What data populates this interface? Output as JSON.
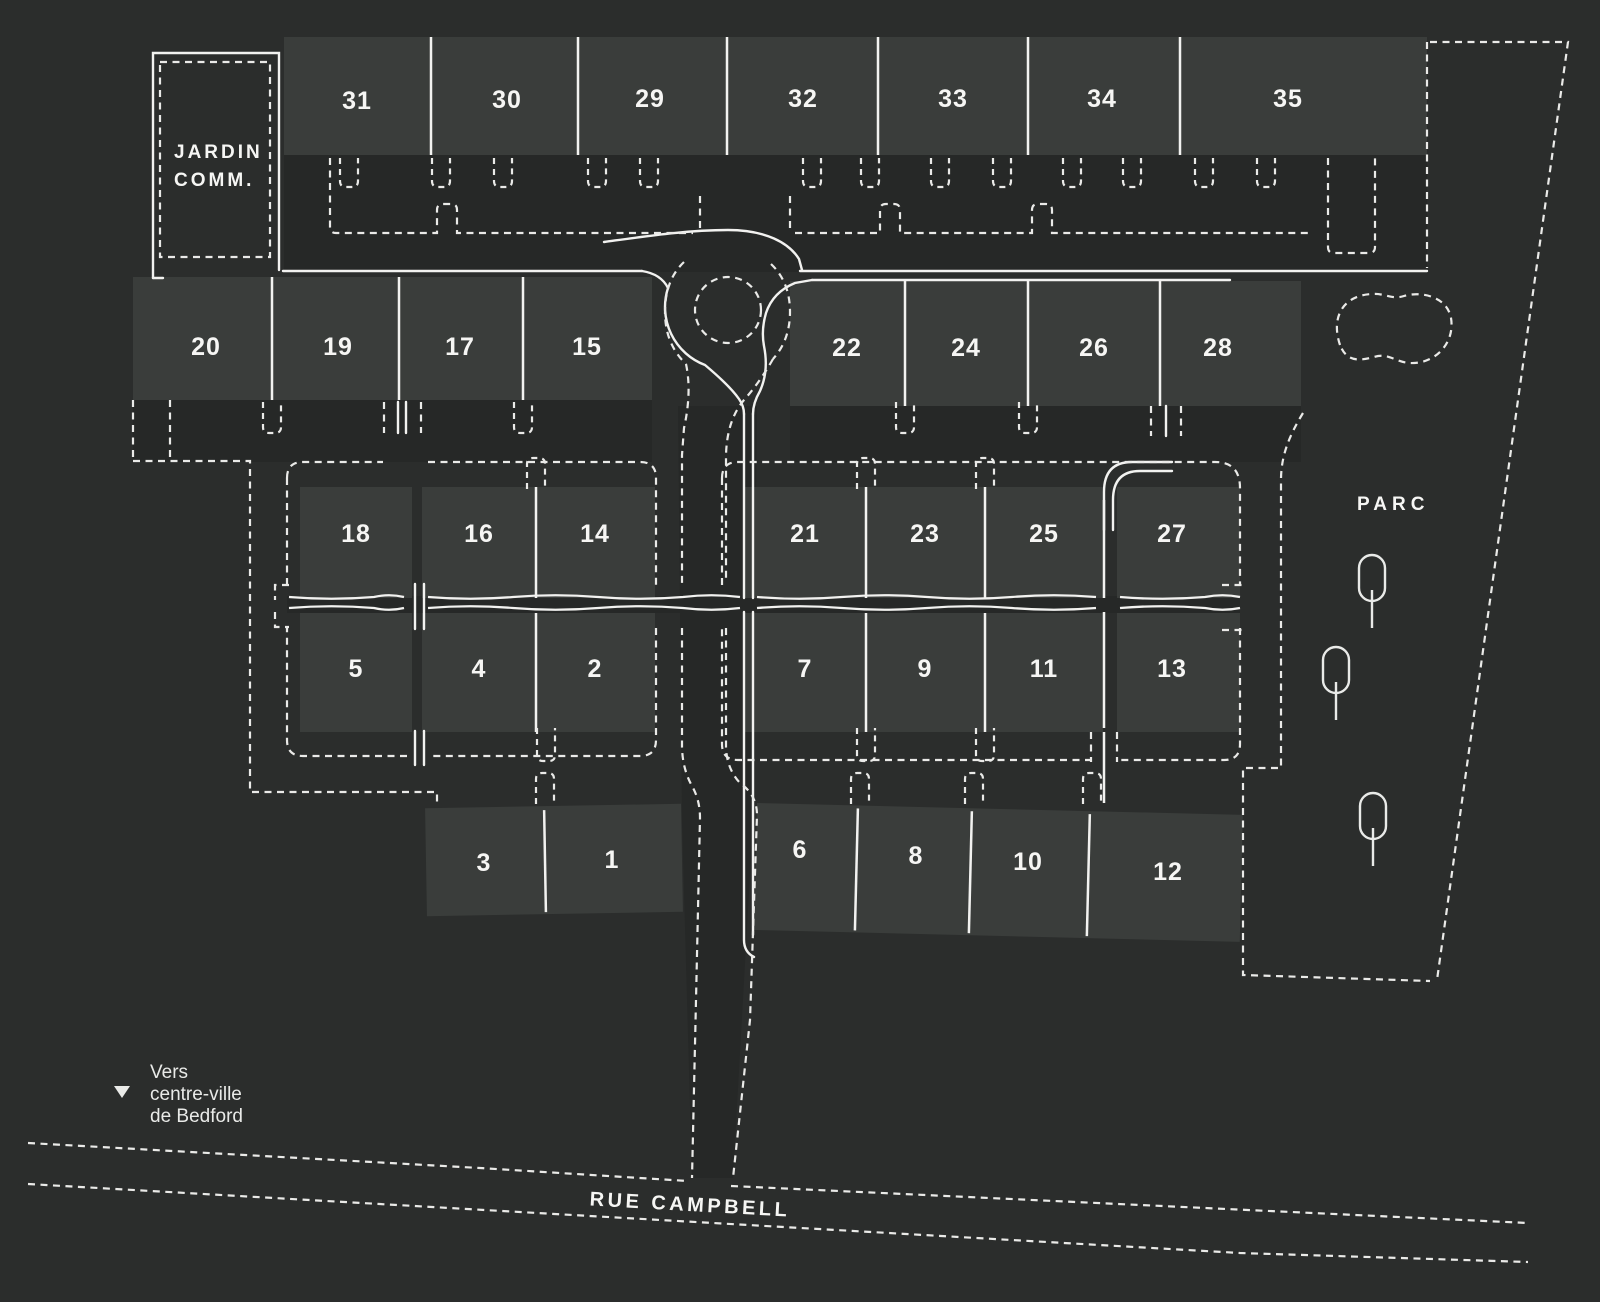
{
  "colors": {
    "background": "#2b2d2c",
    "road": "#262827",
    "lot_fill": "#3a3d3b",
    "line": "#f2f2f0",
    "text": "#f6f6f4"
  },
  "areas": {
    "jardin_line1": "JARDIN",
    "jardin_line2": "COMM.",
    "parc": "PARC",
    "street": "RUE CAMPBELL",
    "direction_line1": "Vers",
    "direction_line2": "centre-ville",
    "direction_line3": "de Bedford"
  },
  "lots": [
    {
      "number": "31",
      "x": 357,
      "y": 100
    },
    {
      "number": "30",
      "x": 507,
      "y": 99
    },
    {
      "number": "29",
      "x": 650,
      "y": 98
    },
    {
      "number": "32",
      "x": 803,
      "y": 98
    },
    {
      "number": "33",
      "x": 953,
      "y": 98
    },
    {
      "number": "34",
      "x": 1102,
      "y": 98
    },
    {
      "number": "35",
      "x": 1288,
      "y": 98
    },
    {
      "number": "20",
      "x": 206,
      "y": 346
    },
    {
      "number": "19",
      "x": 338,
      "y": 346
    },
    {
      "number": "17",
      "x": 460,
      "y": 346
    },
    {
      "number": "15",
      "x": 587,
      "y": 346
    },
    {
      "number": "22",
      "x": 847,
      "y": 347
    },
    {
      "number": "24",
      "x": 966,
      "y": 347
    },
    {
      "number": "26",
      "x": 1094,
      "y": 347
    },
    {
      "number": "28",
      "x": 1218,
      "y": 347
    },
    {
      "number": "18",
      "x": 356,
      "y": 533
    },
    {
      "number": "16",
      "x": 479,
      "y": 533
    },
    {
      "number": "14",
      "x": 595,
      "y": 533
    },
    {
      "number": "21",
      "x": 805,
      "y": 533
    },
    {
      "number": "23",
      "x": 925,
      "y": 533
    },
    {
      "number": "25",
      "x": 1044,
      "y": 533
    },
    {
      "number": "27",
      "x": 1172,
      "y": 533
    },
    {
      "number": "5",
      "x": 356,
      "y": 668
    },
    {
      "number": "4",
      "x": 479,
      "y": 668
    },
    {
      "number": "2",
      "x": 595,
      "y": 668
    },
    {
      "number": "7",
      "x": 805,
      "y": 668
    },
    {
      "number": "9",
      "x": 925,
      "y": 668
    },
    {
      "number": "11",
      "x": 1044,
      "y": 668
    },
    {
      "number": "13",
      "x": 1172,
      "y": 668
    },
    {
      "number": "3",
      "x": 484,
      "y": 862
    },
    {
      "number": "1",
      "x": 612,
      "y": 859
    },
    {
      "number": "6",
      "x": 800,
      "y": 849
    },
    {
      "number": "8",
      "x": 916,
      "y": 855
    },
    {
      "number": "10",
      "x": 1028,
      "y": 861
    },
    {
      "number": "12",
      "x": 1168,
      "y": 871
    }
  ],
  "trees": [
    {
      "x": 1372,
      "y": 578
    },
    {
      "x": 1336,
      "y": 670
    },
    {
      "x": 1373,
      "y": 816
    }
  ]
}
